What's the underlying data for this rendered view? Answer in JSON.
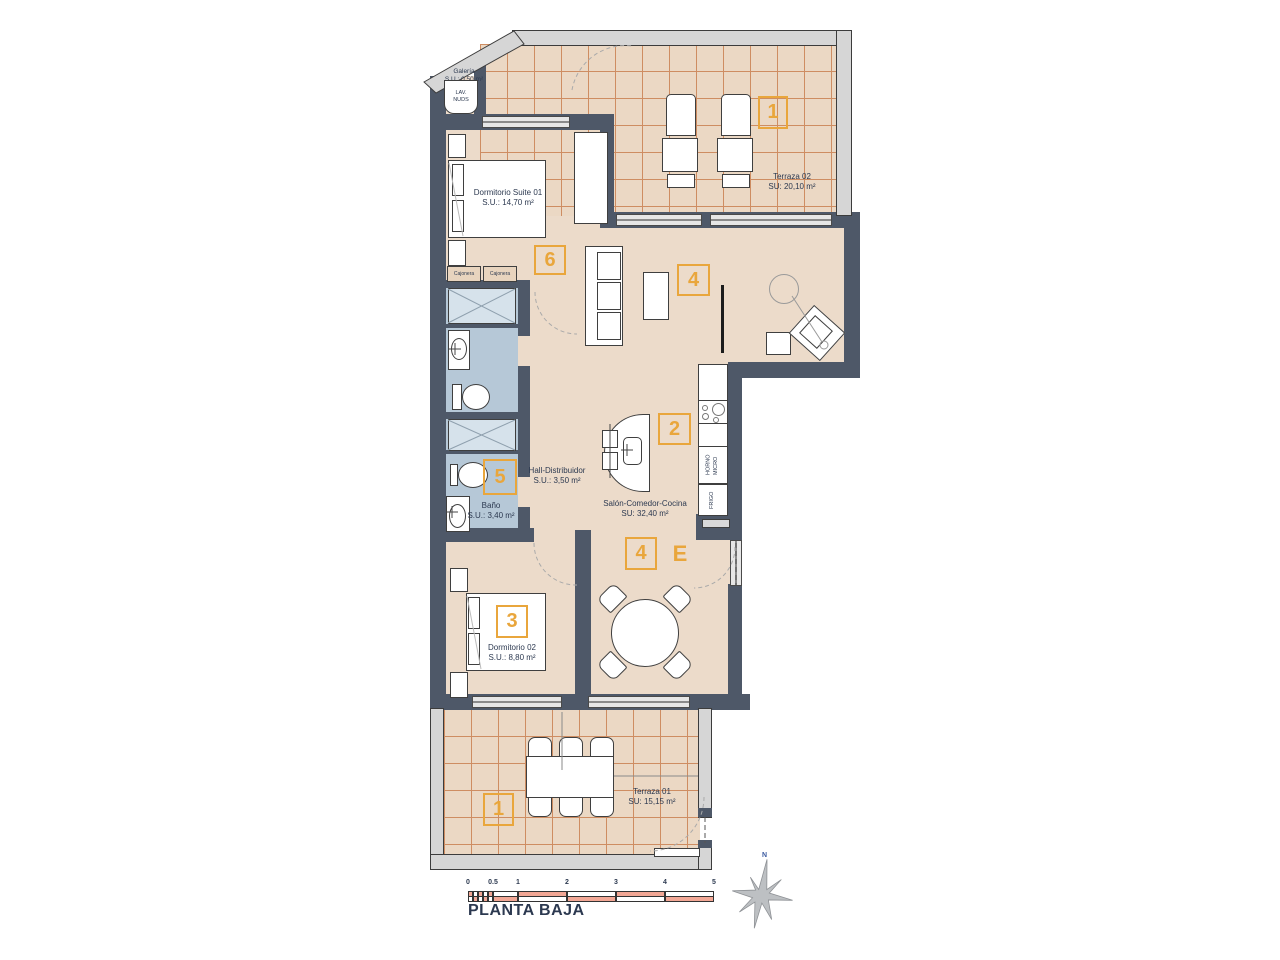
{
  "title": "PLANTA BAJA",
  "compass_north": "N",
  "colors": {
    "accent": "#E9A63C",
    "wall": "#4E5868",
    "floor": "#ECDBCA",
    "bath_floor": "#B6C8D7",
    "tile_line": "#CE8D62",
    "scale_fill": "#F2A795",
    "text": "#2C3950"
  },
  "rooms": {
    "galeria": {
      "name": "Galería",
      "area": "S.U.: 0,50 m²"
    },
    "suite": {
      "name": "Dormitorio Suite 01",
      "area": "S.U.: 14,70 m²"
    },
    "terraza2": {
      "name": "Terraza 02",
      "area": "SU: 20,10 m²"
    },
    "hall": {
      "name": "Hall-Distribuidor",
      "area": "S.U.: 3,50 m²"
    },
    "bano": {
      "name": "Baño",
      "area": "S.U.: 3,40 m²"
    },
    "salon": {
      "name": "Salón-Comedor-Cocina",
      "area": "SU: 32,40 m²"
    },
    "dorm2": {
      "name": "Dormitorio 02",
      "area": "S.U.: 8,80 m²"
    },
    "terraza1": {
      "name": "Terraza 01",
      "area": "SU: 15,15 m²"
    }
  },
  "markers": {
    "terraza2": "1",
    "suite": "6",
    "salon_upper": "4",
    "kitchen": "2",
    "bano": "5",
    "salon_lower": "4",
    "entrance": "E",
    "dorm2": "3",
    "terraza1": "1"
  },
  "fixtures": {
    "cajonera_left": "Cajonera",
    "cajonera_right": "Cajonera",
    "lavadero": "LAV.\nNUDS",
    "horno_micro": "HORNO\nMICRO",
    "frigo": "FRIGO"
  },
  "scale_bar": {
    "ticks": [
      "0",
      "0.5",
      "1",
      "2",
      "3",
      "4",
      "5"
    ]
  }
}
